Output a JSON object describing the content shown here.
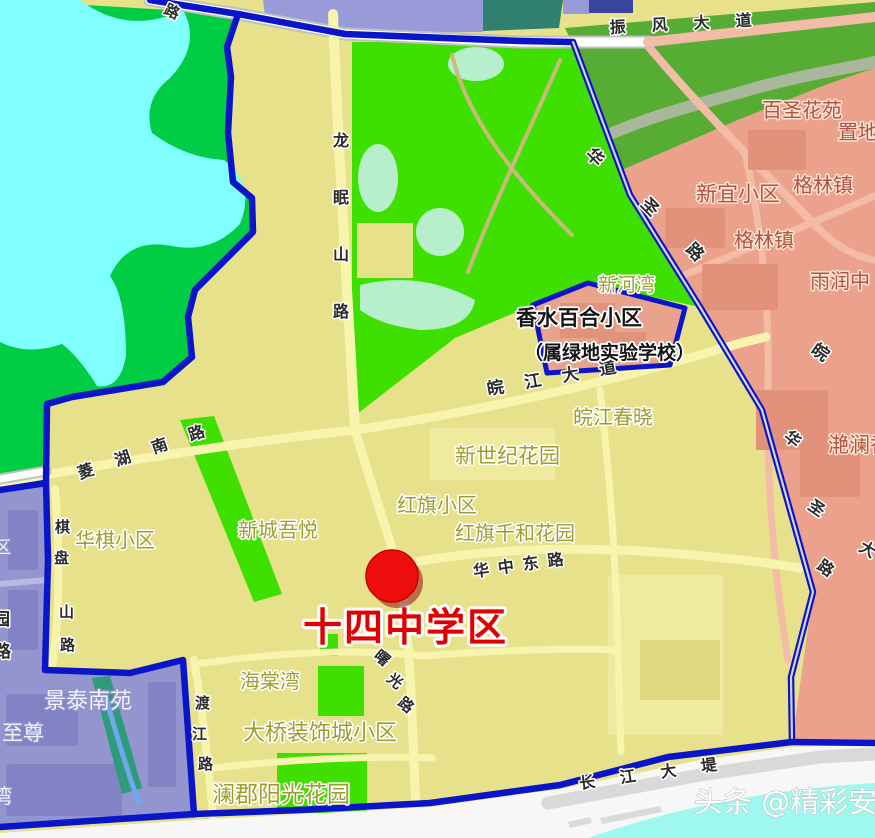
{
  "map": {
    "district_title": "十四中学区",
    "watermark": "头条 @精彩安庆",
    "marker": {
      "x": 392,
      "y": 576,
      "r": 26,
      "color": "#EE0D0D",
      "edge": "#C40000",
      "shadow": "#8E1212"
    },
    "colors": {
      "boundary": "#0A14C8",
      "khaki": "#E8E18B",
      "khakilight": "#F0EA9E",
      "khakidark": "#E0D880",
      "green1": "#3FE000",
      "green2": "#00CC44",
      "green3": "#57AD33",
      "palegreen": "#B7EECB",
      "water": "#80FFFF",
      "rwater": "#9EF8EF",
      "pink": "#EBA18B",
      "pinkdark": "#E2917A",
      "pentagon": "#E8A38D",
      "purple": "#9395CF",
      "purpledark": "#8183C4",
      "lavender": "#999BD8",
      "tealblock": "#2F8070",
      "navy": "#37459B",
      "teal": "#2E9B7B",
      "yroad": "#F7F4AE",
      "pinkroad": "#F3BCA6",
      "roadwhite": "#FFFFFF",
      "roadcase": "#C0C0C0",
      "tan": "#C9B97D",
      "river": "#A9B89C",
      "creek": "#6FA8EC",
      "proad": "#B9BAE4",
      "levee": "#D9D9D9",
      "white": "#F7F7F7",
      "lightgray": "#DADADA"
    },
    "label_styles": {
      "road": {
        "fill": "#2B2B2B",
        "halo": "#FFFFFF",
        "halo_width": 3,
        "bold": true
      },
      "khaki": {
        "fill": "#9E9E30",
        "halo": "#FFFFFF",
        "halo_width": 3,
        "bold": false
      },
      "brick": {
        "fill": "#B2543B",
        "halo": "#FBE3D6",
        "halo_width": 3,
        "bold": false
      },
      "black": {
        "fill": "#151515",
        "halo": "#FFFFFF",
        "halo_width": 3.5,
        "bold": true
      },
      "purple": {
        "fill": "#F2F2FF",
        "halo": "#9193C8",
        "halo_width": 2.5,
        "bold": false
      },
      "title": {
        "fill": "#E10000",
        "halo": "#FFFFFF",
        "halo_width": 6,
        "bold": true
      },
      "watermark": {
        "fill": "#FFFFFF",
        "halo": "#B9B9B9",
        "halo_width": 1,
        "bold": false
      }
    },
    "labels": [
      {
        "name": "road-zhenfeng-avenue",
        "text": "振风大道",
        "x": 610,
        "y": 33,
        "size": 16,
        "style": "road",
        "rot": -3,
        "ls": 26
      },
      {
        "name": "road-top-partial",
        "text": "路",
        "x": 163,
        "y": 13,
        "size": 15,
        "style": "road",
        "rot": 25
      },
      {
        "name": "road-longmianshan",
        "text": "龙眠山路",
        "x": 333,
        "y": 146,
        "size": 16,
        "style": "road",
        "vert": true,
        "gap": 57
      },
      {
        "name": "road-huasheng-upper-1",
        "text": "华",
        "x": 585,
        "y": 155,
        "size": 17,
        "style": "road",
        "rot": 45
      },
      {
        "name": "road-huasheng-upper-2",
        "text": "圣",
        "x": 640,
        "y": 205,
        "size": 17,
        "style": "road",
        "rot": 45
      },
      {
        "name": "road-huasheng-upper-3",
        "text": "路",
        "x": 685,
        "y": 250,
        "size": 17,
        "style": "road",
        "rot": 45
      },
      {
        "name": "road-wanjiang-avenue",
        "text": "皖江大道",
        "x": 488,
        "y": 395,
        "size": 17,
        "style": "road",
        "rot": -10,
        "ls": 21
      },
      {
        "name": "road-linghu-south",
        "text": "菱湖南路",
        "x": 80,
        "y": 479,
        "size": 16,
        "style": "road",
        "rot": -19,
        "ls": 23
      },
      {
        "name": "road-qipanshan-1",
        "text": "棋",
        "x": 55,
        "y": 532,
        "size": 15,
        "style": "road"
      },
      {
        "name": "road-qipanshan-2",
        "text": "盘",
        "x": 54,
        "y": 563,
        "size": 15,
        "style": "road"
      },
      {
        "name": "road-qipanshan-3",
        "text": "山",
        "x": 59,
        "y": 617,
        "size": 15,
        "style": "road"
      },
      {
        "name": "road-qipanshan-4",
        "text": "路",
        "x": 60,
        "y": 650,
        "size": 15,
        "style": "road"
      },
      {
        "name": "road-wan-char",
        "text": "皖",
        "x": 810,
        "y": 352,
        "size": 17,
        "style": "road",
        "rot": 35
      },
      {
        "name": "road-huasheng-lower-1",
        "text": "华",
        "x": 783,
        "y": 438,
        "size": 16,
        "style": "road",
        "rot": 40
      },
      {
        "name": "road-huasheng-lower-2",
        "text": "圣",
        "x": 807,
        "y": 508,
        "size": 16,
        "style": "road",
        "rot": 35
      },
      {
        "name": "road-huasheng-lower-3",
        "text": "路",
        "x": 816,
        "y": 568,
        "size": 16,
        "style": "road",
        "rot": 35
      },
      {
        "name": "road-da-partial",
        "text": "大",
        "x": 858,
        "y": 550,
        "size": 16,
        "style": "road",
        "rot": 30
      },
      {
        "name": "road-huazhong-east",
        "text": "华中东路",
        "x": 474,
        "y": 577,
        "size": 16,
        "style": "road",
        "rot": -8,
        "ls": 9
      },
      {
        "name": "road-shuguang-1",
        "text": "曙",
        "x": 373,
        "y": 657,
        "size": 15,
        "style": "road",
        "rot": 40
      },
      {
        "name": "road-shuguang-2",
        "text": "光",
        "x": 386,
        "y": 680,
        "size": 15,
        "style": "road",
        "rot": 40
      },
      {
        "name": "road-shuguang-3",
        "text": "路",
        "x": 397,
        "y": 704,
        "size": 15,
        "style": "road",
        "rot": 40
      },
      {
        "name": "road-dujiang-1",
        "text": "渡",
        "x": 195,
        "y": 708,
        "size": 15,
        "style": "road"
      },
      {
        "name": "road-dujiang-2",
        "text": "江",
        "x": 192,
        "y": 739,
        "size": 15,
        "style": "road"
      },
      {
        "name": "road-dujiang-3",
        "text": "路",
        "x": 198,
        "y": 769,
        "size": 15,
        "style": "road"
      },
      {
        "name": "road-changjiang-levee",
        "text": "长江大堤",
        "x": 580,
        "y": 789,
        "size": 16,
        "style": "road",
        "rot": -8,
        "ls": 25
      },
      {
        "name": "area-xinhewan",
        "text": "新河湾",
        "x": 598,
        "y": 291,
        "size": 19,
        "style": "khaki"
      },
      {
        "name": "area-wanjiang-chunxiao",
        "text": "皖江春晓",
        "x": 573,
        "y": 424,
        "size": 20,
        "style": "khaki"
      },
      {
        "name": "area-xinshiji-garden",
        "text": "新世纪花园",
        "x": 455,
        "y": 463,
        "size": 21,
        "style": "khaki"
      },
      {
        "name": "area-hongqi-community",
        "text": "红旗小区",
        "x": 397,
        "y": 512,
        "size": 20,
        "style": "khaki"
      },
      {
        "name": "area-hongqi-qianhe",
        "text": "红旗千和花园",
        "x": 455,
        "y": 540,
        "size": 20,
        "style": "khaki"
      },
      {
        "name": "area-huaqi-community",
        "text": "华棋小区",
        "x": 75,
        "y": 547,
        "size": 20,
        "style": "khaki"
      },
      {
        "name": "area-xincheng-wuyue",
        "text": "新城吾悦",
        "x": 238,
        "y": 537,
        "size": 20,
        "style": "khaki"
      },
      {
        "name": "area-haitangwan",
        "text": "海棠湾",
        "x": 240,
        "y": 688,
        "size": 20,
        "style": "khaki"
      },
      {
        "name": "area-daqiao-zhuangshi",
        "text": "大桥装饰城小区",
        "x": 243,
        "y": 740,
        "size": 22,
        "style": "khaki"
      },
      {
        "name": "area-lanjun-yangguang",
        "text": "澜郡阳光花园",
        "x": 212,
        "y": 802,
        "size": 23,
        "style": "khaki"
      },
      {
        "name": "area-baisheng-huayuan",
        "text": "百圣花苑",
        "x": 762,
        "y": 117,
        "size": 20,
        "style": "brick"
      },
      {
        "name": "area-zhidi",
        "text": "置地",
        "x": 838,
        "y": 139,
        "size": 20,
        "style": "brick"
      },
      {
        "name": "area-xinyi-community",
        "text": "新宜小区",
        "x": 696,
        "y": 201,
        "size": 21,
        "style": "brick"
      },
      {
        "name": "area-gelin-town-1",
        "text": "格林镇",
        "x": 793,
        "y": 192,
        "size": 20,
        "style": "brick"
      },
      {
        "name": "area-gelin-town-2",
        "text": "格林镇",
        "x": 734,
        "y": 247,
        "size": 20,
        "style": "brick"
      },
      {
        "name": "area-yurun-partial",
        "text": "雨润中",
        "x": 810,
        "y": 288,
        "size": 20,
        "style": "brick"
      },
      {
        "name": "area-yanlan-partial",
        "text": "滟澜香",
        "x": 828,
        "y": 452,
        "size": 21,
        "style": "brick"
      },
      {
        "name": "area-xiangshui-baihe",
        "text": "香水百合小区",
        "x": 516,
        "y": 325,
        "size": 21,
        "style": "black"
      },
      {
        "name": "area-lvdi-school-note",
        "text": "（属绿地实验学校）",
        "x": 524,
        "y": 359,
        "size": 19,
        "style": "black"
      },
      {
        "name": "area-jingtai-nanyuan",
        "text": "景泰南苑",
        "x": 44,
        "y": 708,
        "size": 22,
        "style": "purple"
      },
      {
        "name": "area-zhizun-partial",
        "text": "至尊",
        "x": 2,
        "y": 740,
        "size": 21,
        "style": "purple"
      },
      {
        "name": "area-wan-partial",
        "text": "湾",
        "x": -8,
        "y": 803,
        "size": 20,
        "style": "purple"
      },
      {
        "name": "area-qu-partial",
        "text": "区",
        "x": -6,
        "y": 553,
        "size": 17,
        "style": "purple"
      },
      {
        "name": "area-yuan-partial",
        "text": "园",
        "x": -7,
        "y": 625,
        "size": 17,
        "style": "road"
      },
      {
        "name": "area-lu-partial",
        "text": "路",
        "x": -6,
        "y": 657,
        "size": 17,
        "style": "road"
      },
      {
        "name": "district-title",
        "text": "十四中学区",
        "x": 303,
        "y": 641,
        "size": 39,
        "style": "title",
        "ls": 2
      },
      {
        "name": "watermark",
        "text": "头条 @精彩安庆",
        "x": 694,
        "y": 812,
        "size": 29,
        "style": "watermark"
      }
    ]
  }
}
